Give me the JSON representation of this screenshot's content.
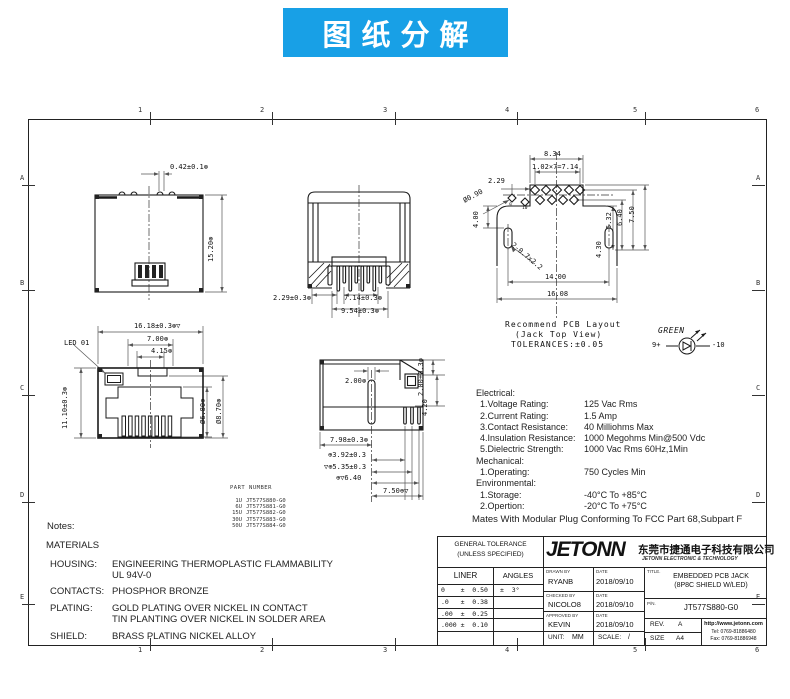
{
  "banner": {
    "title": "图纸分解"
  },
  "grid": {
    "cols": [
      "1",
      "2",
      "3",
      "4",
      "5",
      "6"
    ],
    "rows": [
      "A",
      "B",
      "C",
      "D",
      "E"
    ]
  },
  "top_view": {
    "dim_tab": "0.42±0.1⊛",
    "dim_height": "15.20⊛"
  },
  "bottom_view": {
    "dim_offset": "2.29±0.3⊛",
    "dim_pin_span": "7.14±0.3⊛",
    "dim_outer_span": "9.54±0.3⊛"
  },
  "pcb_layout": {
    "line1": "Recommend PCB Layout",
    "line2": "(Jack Top View)",
    "line3": "TOLERANCES:±0.05",
    "dim_834": "8.34",
    "dim_pitch": "1.02×7=7.14",
    "dim_229": "2.29",
    "dim_hole": "Ø0.90",
    "dim_400": "4.00",
    "dim_slot": "2-0.7x2.2",
    "dim_1400": "14.00",
    "dim_1608": "16.08",
    "dim_430": "4.30",
    "dim_532": "5.32",
    "dim_640": "6.40",
    "dim_750": "7.50",
    "pin9": "9",
    "pin10": "10",
    "led_color": "GREEN",
    "led_anode": "9+",
    "led_cathode": "-10"
  },
  "front_view": {
    "led_label": "LED 01",
    "dim_width": "16.18±0.3⊛▽",
    "dim_700": "7.00⊛",
    "dim_415": "4.15⊛",
    "dim_height": "11.10±0.3⊛",
    "dim_680": "Ø6.80⊛",
    "dim_870": "Ø8.70⊛"
  },
  "side_view": {
    "dim_200": "2.00⊛",
    "dim_200t": "2.00±0.3⊛",
    "dim_420": "4.20",
    "dim_798": "7.98±0.3⊛",
    "dim_392": "⊕3.92±0.3",
    "dim_535": "▽⊕5.35±0.3",
    "dim_640": "⊕▽6.40",
    "dim_750": "7.50⊕▽"
  },
  "part_number": {
    "title": "PART NUMBER",
    "rows": [
      {
        "u": "1U",
        "pn": "JT577S880-G0"
      },
      {
        "u": "6U",
        "pn": "JT577S881-G0"
      },
      {
        "u": "15U",
        "pn": "JT577S882-G0"
      },
      {
        "u": "30U",
        "pn": "JT577S883-G0"
      },
      {
        "u": "50U",
        "pn": "JT577S884-G0"
      }
    ]
  },
  "specs": {
    "electrical_title": "Electrical:",
    "electrical": [
      {
        "label": "1.Voltage Rating:",
        "value": "125 Vac Rms"
      },
      {
        "label": "2.Current Rating:",
        "value": "1.5 Amp"
      },
      {
        "label": "3.Contact Resistance:",
        "value": "40 Milliohms Max"
      },
      {
        "label": "4.Insulation Resistance:",
        "value": "1000 Megohms Min@500 Vdc"
      },
      {
        "label": "5.Dielectric Strength:",
        "value": "1000 Vac Rms 60Hz,1Min"
      }
    ],
    "mechanical_title": "Mechanical:",
    "mechanical": [
      {
        "label": "1.Operating:",
        "value": "750 Cycles Min"
      }
    ],
    "environmental_title": "Environmental:",
    "environmental": [
      {
        "label": "1.Storage:",
        "value": "-40°C To +85°C"
      },
      {
        "label": "2.Opertion:",
        "value": "-20°C To +75°C"
      }
    ],
    "footnote": "Mates With Modular Plug Conforming To FCC Part 68,Subpart F"
  },
  "notes": {
    "label": "Notes:",
    "materials": "MATERIALS",
    "items": [
      {
        "name": "HOUSING:",
        "line1": "ENGINEERING THERMOPLASTIC FLAMMABILITY",
        "line2": "UL 94V-0"
      },
      {
        "name": "CONTACTS:",
        "line1": "PHOSPHOR BRONZE",
        "line2": ""
      },
      {
        "name": "PLATING:",
        "line1": "GOLD PLATING OVER NICKEL IN CONTACT",
        "line2": "TIN PLANTING OVER NICKEL IN SOLDER AREA"
      },
      {
        "name": "SHIELD:",
        "line1": "BRASS PLATING NICKEL ALLOY",
        "line2": ""
      }
    ]
  },
  "title_block": {
    "general_tolerance_1": "GENERAL TOLERANCE",
    "general_tolerance_2": "(UNLESS SPECIFIED)",
    "liner": "LINER",
    "angles": "ANGLES",
    "rows": [
      {
        "liner": "0    ±  0.50",
        "angles": "±  3°"
      },
      {
        "liner": ".0   ±  0.38",
        "angles": ""
      },
      {
        "liner": ".00  ±  0.25",
        "angles": ""
      },
      {
        "liner": ".000 ±  0.10",
        "angles": ""
      }
    ],
    "logo": "JETONN",
    "company_cn": "东莞市捷通电子科技有限公司",
    "company_en": "JETONN ELECTRONIC & TECHNOLOGY",
    "drawn_label": "DRAWN BY",
    "drawn": "RYANB",
    "checked_label": "CHECKED BY",
    "checked": "NICOLO8",
    "approved_label": "APPROVED BY",
    "approved": "KEVIN",
    "date_label": "DATE",
    "date": "2018/09/10",
    "unit_label": "UNIT:",
    "unit": "MM",
    "scale_label": "SCALE:",
    "scale": "/",
    "title_label": "TITLE.",
    "title_1": "EMBEDDED PCB JACK",
    "title_2": "(8P8C SHIELD W/LED)",
    "pn_label": "P/N.",
    "pn": "JT577S880-G0",
    "rev_label": "REV.",
    "rev": "A",
    "size_label": "SIZE",
    "size": "A4",
    "website": "http://www.jetonn.com",
    "tel": "Tel: 0769-81886480",
    "fax": "Fax: 0769-81886948"
  }
}
